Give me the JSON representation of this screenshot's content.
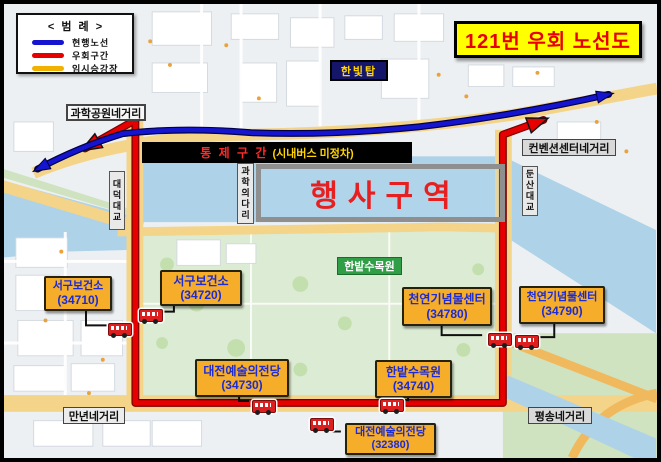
{
  "title": "121번 우회 노선도",
  "legend": {
    "title": "< 범 례 >",
    "items": [
      {
        "label": "현행노선",
        "color": "#1515d0"
      },
      {
        "label": "우회구간",
        "color": "#e60000"
      },
      {
        "label": "임시승강장",
        "color": "#f2b000"
      }
    ]
  },
  "control_banner": {
    "zone": "통 제 구 간",
    "note": "(시내버스 미정차)"
  },
  "event_zone_label": "행사구역",
  "landmarks": {
    "tower": "한빛탑",
    "arboretum": "한밭수목원",
    "science_bridge": "과학의다리",
    "daedeok_bridge": "대덕대교",
    "dunsan_bridge": "둔산대교"
  },
  "intersections": {
    "science_park": "과학공원네거리",
    "convention_center": "컨벤션센터네거리",
    "mannyeon": "만년네거리",
    "pyeongsong": "평송네거리"
  },
  "stops": [
    {
      "name": "서구보건소",
      "code": "(34710)"
    },
    {
      "name": "서구보건소",
      "code": "(34720)"
    },
    {
      "name": "천연기념물센터",
      "code": "(34780)"
    },
    {
      "name": "천연기념물센터",
      "code": "(34790)"
    },
    {
      "name": "대전예술의전당",
      "code": "(34730)"
    },
    {
      "name": "한밭수목원",
      "code": "(34740)"
    },
    {
      "name": "대전예술의전당",
      "code": "(32380)"
    }
  ],
  "colors": {
    "title_bg": "#ffff00",
    "title_text": "#e60000",
    "stop_bg": "#f5ad2a",
    "stop_text": "#1b2bd6",
    "event_text": "#e62020",
    "banner_zone_text": "#ff2a2a",
    "banner_note_text": "#ffd400",
    "route_current": "#1515d0",
    "route_detour": "#e60000",
    "temp_stop": "#f2b000"
  }
}
